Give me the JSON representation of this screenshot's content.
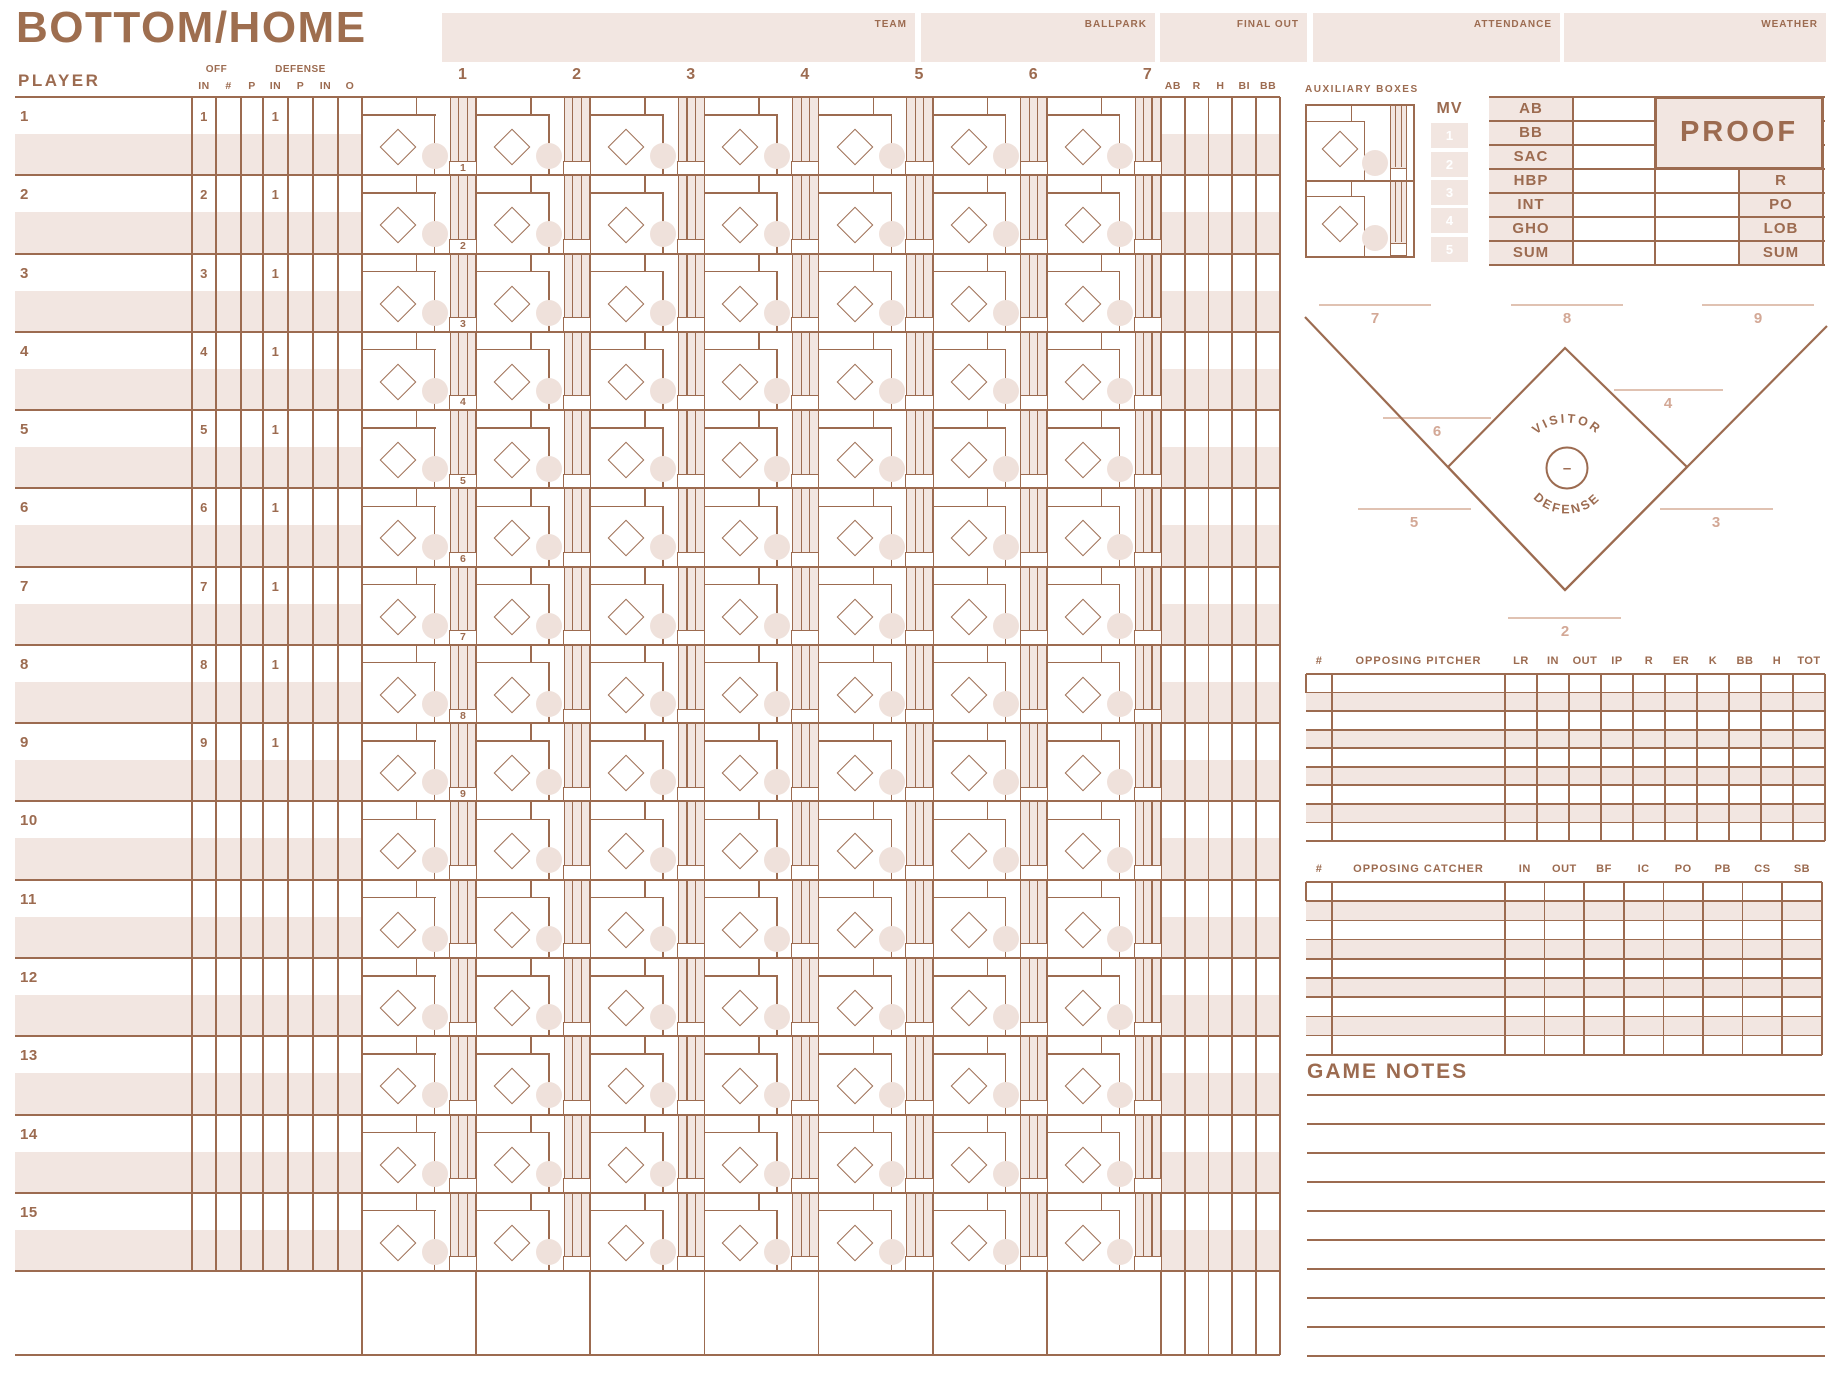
{
  "title": "BOTTOM/HOME",
  "header_fields": [
    {
      "label": "TEAM"
    },
    {
      "label": "BALLPARK"
    },
    {
      "label": "FINAL OUT"
    },
    {
      "label": "ATTENDANCE"
    },
    {
      "label": "WEATHER"
    }
  ],
  "colors": {
    "brown": "#9C6B50",
    "pink": "#F2E6E1",
    "pink_circle": "#EFE1DB",
    "light_text": "#D3A896",
    "light_line": "#E0C2B2",
    "white": "#FFFFFF"
  },
  "roster": {
    "header": "PLAYER",
    "off_group": "OFF",
    "defense_group": "DEFENSE",
    "sub_columns": [
      "IN",
      "#",
      "P",
      "IN",
      "P",
      "IN",
      "O"
    ],
    "rows": [
      {
        "num": "1",
        "off_in": "1",
        "def_in": "1"
      },
      {
        "num": "2",
        "off_in": "2",
        "def_in": "1"
      },
      {
        "num": "3",
        "off_in": "3",
        "def_in": "1"
      },
      {
        "num": "4",
        "off_in": "4",
        "def_in": "1"
      },
      {
        "num": "5",
        "off_in": "5",
        "def_in": "1"
      },
      {
        "num": "6",
        "off_in": "6",
        "def_in": "1"
      },
      {
        "num": "7",
        "off_in": "7",
        "def_in": "1"
      },
      {
        "num": "8",
        "off_in": "8",
        "def_in": "1"
      },
      {
        "num": "9",
        "off_in": "9",
        "def_in": "1"
      },
      {
        "num": "10",
        "off_in": "",
        "def_in": ""
      },
      {
        "num": "11",
        "off_in": "",
        "def_in": ""
      },
      {
        "num": "12",
        "off_in": "",
        "def_in": ""
      },
      {
        "num": "13",
        "off_in": "",
        "def_in": ""
      },
      {
        "num": "14",
        "off_in": "",
        "def_in": ""
      },
      {
        "num": "15",
        "off_in": "",
        "def_in": ""
      }
    ]
  },
  "innings": [
    "1",
    "2",
    "3",
    "4",
    "5",
    "6",
    "7"
  ],
  "stat_columns": [
    "AB",
    "R",
    "H",
    "BI",
    "BB"
  ],
  "inning_marker_numbers": [
    "1",
    "2",
    "3",
    "4",
    "5",
    "6",
    "7",
    "8",
    "9"
  ],
  "auxiliary": {
    "label": "AUXILIARY BOXES",
    "box_count": 2
  },
  "mv": {
    "label": "MV",
    "numbers": [
      "1",
      "2",
      "3",
      "4",
      "5"
    ]
  },
  "proof": {
    "title": "PROOF",
    "left_rows": [
      "AB",
      "BB",
      "SAC",
      "HBP",
      "INT",
      "GHO",
      "SUM"
    ],
    "right_rows": [
      "R",
      "PO",
      "LOB",
      "SUM"
    ]
  },
  "defense": {
    "top_text": "VISITOR",
    "bottom_text": "DEFENSE",
    "pitcher_mark": "–",
    "positions": {
      "p2": "2",
      "p3": "3",
      "p4": "4",
      "p5": "5",
      "p6": "6",
      "p7": "7",
      "p8": "8",
      "p9": "9"
    }
  },
  "pitcher_table": {
    "number_header": "#",
    "name_header": "OPPOSING PITCHER",
    "stat_columns": [
      "LR",
      "IN",
      "OUT",
      "IP",
      "R",
      "ER",
      "K",
      "BB",
      "H",
      "TOT"
    ],
    "row_count": 9
  },
  "catcher_table": {
    "number_header": "#",
    "name_header": "OPPOSING CATCHER",
    "stat_columns": [
      "IN",
      "OUT",
      "BF",
      "IC",
      "PO",
      "PB",
      "CS",
      "SB"
    ],
    "row_count": 9
  },
  "game_notes": {
    "label": "GAME NOTES",
    "line_count": 10
  }
}
